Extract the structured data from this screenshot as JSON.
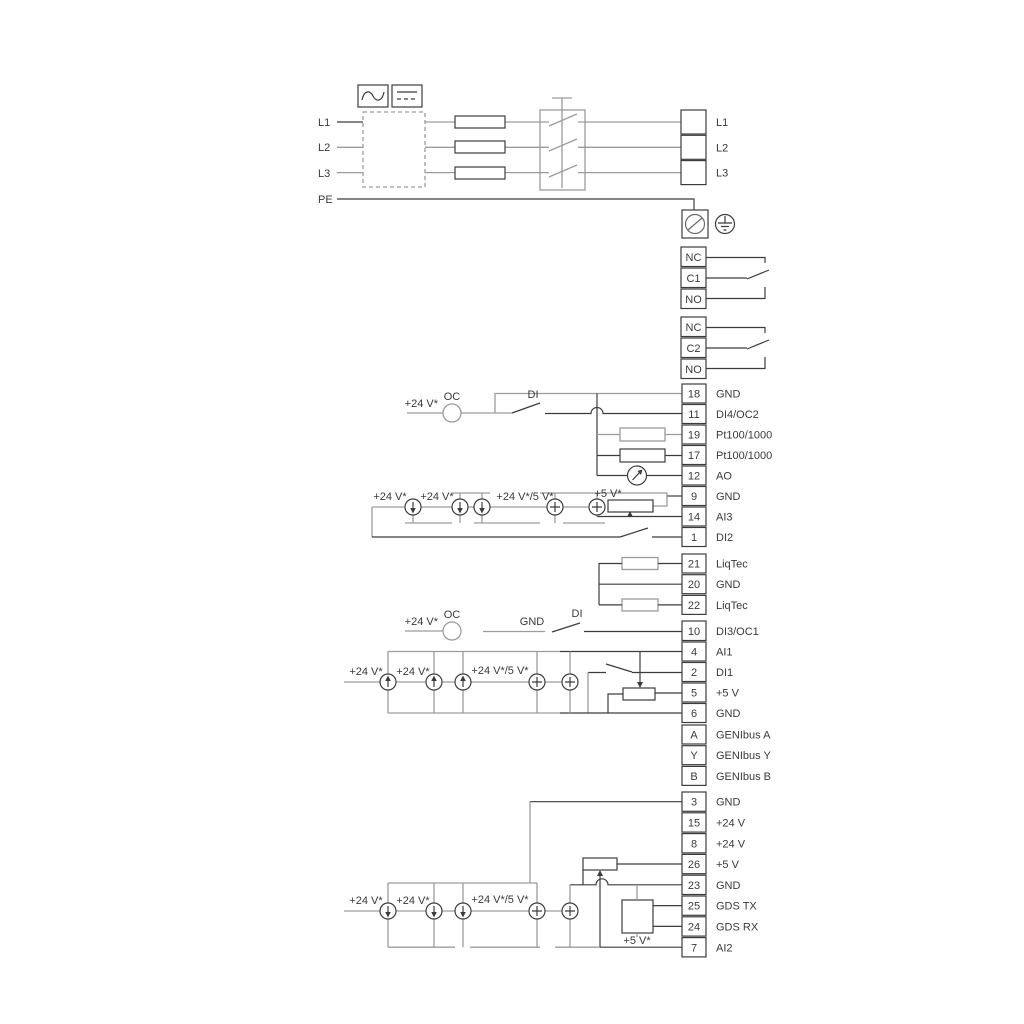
{
  "colors": {
    "line_dark": "#3c3c3c",
    "line_gray": "#9c9c9c",
    "text": "#3a3a3a",
    "background": "#ffffff"
  },
  "power": {
    "left_labels": [
      "L1",
      "L2",
      "L3",
      "PE"
    ]
  },
  "strips": {
    "mains": [
      {
        "out": "L1"
      },
      {
        "out": "L2"
      },
      {
        "out": "L3"
      }
    ],
    "relay1": [
      {
        "in": "NC"
      },
      {
        "in": "C1"
      },
      {
        "in": "NO"
      }
    ],
    "relay2": [
      {
        "in": "NC"
      },
      {
        "in": "C2"
      },
      {
        "in": "NO"
      }
    ],
    "io1": [
      {
        "in": "18",
        "out": "GND"
      },
      {
        "in": "11",
        "out": "DI4/OC2"
      },
      {
        "in": "19",
        "out": "Pt100/1000"
      },
      {
        "in": "17",
        "out": "Pt100/1000"
      },
      {
        "in": "12",
        "out": "AO"
      },
      {
        "in": "9",
        "out": "GND"
      },
      {
        "in": "14",
        "out": "AI3"
      },
      {
        "in": "1",
        "out": "DI2"
      }
    ],
    "liqtec": [
      {
        "in": "21",
        "out": "LiqTec"
      },
      {
        "in": "20",
        "out": "GND"
      },
      {
        "in": "22",
        "out": "LiqTec"
      }
    ],
    "di3": [
      {
        "in": "10",
        "out": "DI3/OC1"
      }
    ],
    "io2": [
      {
        "in": "4",
        "out": "AI1"
      },
      {
        "in": "2",
        "out": "DI1"
      },
      {
        "in": "5",
        "out": "+5 V"
      },
      {
        "in": "6",
        "out": "GND"
      }
    ],
    "genibus": [
      {
        "in": "A",
        "out": "GENIbus A"
      },
      {
        "in": "Y",
        "out": "GENIbus Y"
      },
      {
        "in": "B",
        "out": "GENIbus B"
      }
    ],
    "io3": [
      {
        "in": "3",
        "out": "GND"
      },
      {
        "in": "15",
        "out": "+24 V"
      },
      {
        "in": "8",
        "out": "+24 V"
      },
      {
        "in": "26",
        "out": "+5 V"
      },
      {
        "in": "23",
        "out": "GND"
      },
      {
        "in": "25",
        "out": "GDS TX"
      },
      {
        "in": "24",
        "out": "GDS RX"
      },
      {
        "in": "7",
        "out": "AI2"
      }
    ]
  },
  "annotations": {
    "oc_top": {
      "supply": "+24 V*",
      "oc": "OC",
      "di": "DI"
    },
    "ai3": {
      "s1": "+24 V*",
      "s2": "+24 V*",
      "s3": "+24 V*/5 V*",
      "s4": "+5 V*"
    },
    "oc_bot": {
      "supply": "+24 V*",
      "oc": "OC",
      "gnd": "GND",
      "di": "DI"
    },
    "ai1": {
      "s1": "+24 V*",
      "s2": "+24 V*",
      "s3": "+24 V*/5 V*"
    },
    "ai2": {
      "s1": "+24 V*",
      "s2": "+24 V*",
      "s3": "+24 V*/5 V*",
      "s4": "+5 V*"
    }
  }
}
